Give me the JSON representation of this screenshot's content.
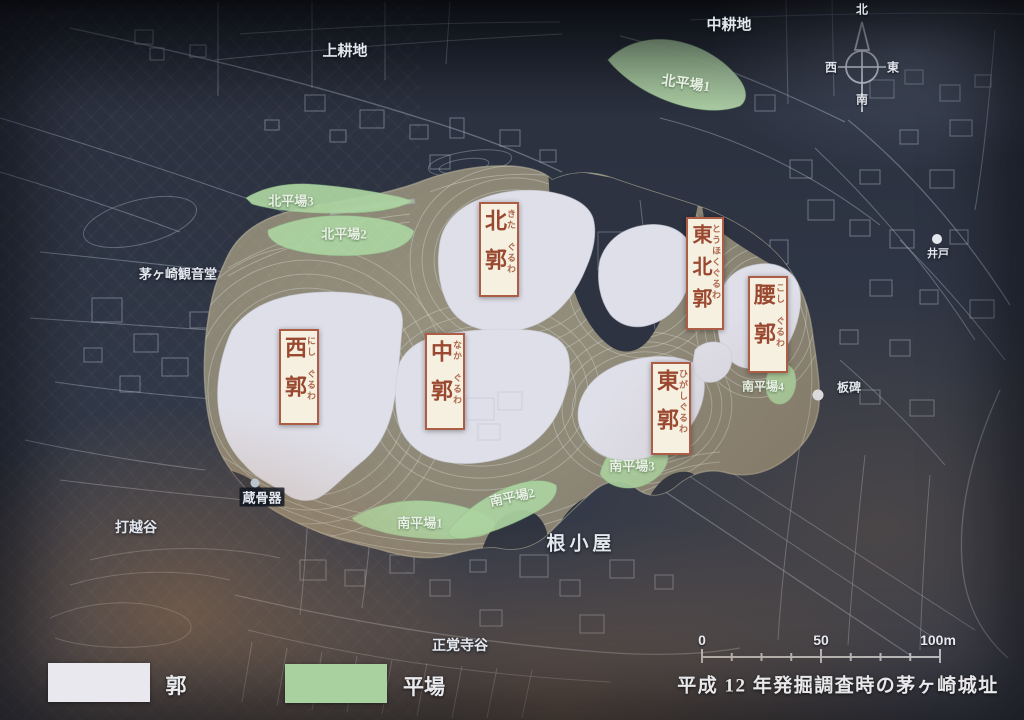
{
  "map": {
    "caption": "平成 12 年発掘調査時の茅ヶ崎城址",
    "legend": {
      "kuruwa_label": "郭",
      "hiraba_label": "平場",
      "kuruwa_color": "#e9e8ee",
      "hiraba_color": "#a9d19f"
    },
    "scale": {
      "zero": "0",
      "fifty": "50",
      "hundred": "100m"
    },
    "compass": {
      "north": "北",
      "south": "南",
      "east": "東",
      "west": "西"
    },
    "enclosures": [
      {
        "id": "nishi",
        "kanji": "西郭",
        "furigana": "にし　ぐるわ"
      },
      {
        "id": "kita",
        "kanji": "北郭",
        "furigana": "きた　ぐるわ"
      },
      {
        "id": "naka",
        "kanji": "中郭",
        "furigana": "なか　ぐるわ"
      },
      {
        "id": "tohoku",
        "kanji": "東北郭",
        "furigana": "とうほくぐるわ"
      },
      {
        "id": "higashi",
        "kanji": "東郭",
        "furigana": "ひがしぐるわ"
      },
      {
        "id": "koshi",
        "kanji": "腰郭",
        "furigana": "こし　ぐるわ"
      }
    ],
    "flats": [
      {
        "label": "北平場1"
      },
      {
        "label": "北平場2"
      },
      {
        "label": "北平場3"
      },
      {
        "label": "南平場1"
      },
      {
        "label": "南平場2"
      },
      {
        "label": "南平場3"
      },
      {
        "label": "南平場4"
      }
    ],
    "places": [
      {
        "label": "上耕地"
      },
      {
        "label": "中耕地"
      },
      {
        "label": "茅ヶ崎観音堂"
      },
      {
        "label": "打越谷"
      },
      {
        "label": "根小屋"
      },
      {
        "label": "正覚寺谷"
      }
    ],
    "points": [
      {
        "label": "井戸"
      },
      {
        "label": "板碑"
      },
      {
        "label": "蔵骨器"
      }
    ],
    "colors": {
      "background": "#313847",
      "hill": "#8c8677",
      "enclosure_fill": "#dfdfe9",
      "flat_fill": "#abd3a0",
      "label_box_bg": "#f6f0e0",
      "label_box_border": "#ad5d45",
      "label_text_red": "#9a4830"
    }
  }
}
